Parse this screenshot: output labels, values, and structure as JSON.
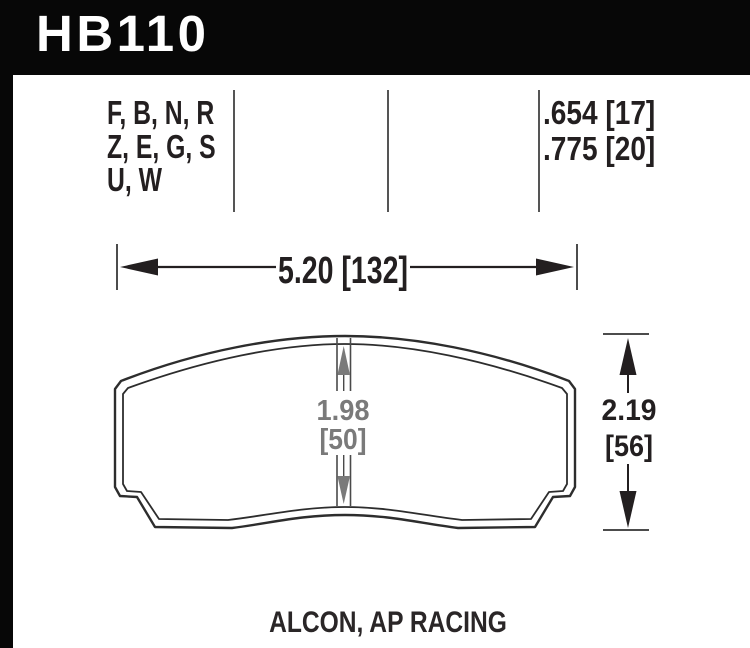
{
  "part": {
    "number": "HB110"
  },
  "spec_table": {
    "compound_lines": [
      "F, B, N, R",
      "Z, E, G, S",
      "U, W"
    ],
    "pad_thickness_lines": [
      ".654 [17]",
      ".775 [20]"
    ]
  },
  "dimensions": {
    "width_label": "5.20 [132]",
    "height_value": "2.19",
    "height_bracket": "[56]",
    "center_value": "1.98",
    "center_bracket": "[50]"
  },
  "footer": {
    "applications": "ALCON, AP RACING"
  },
  "colors": {
    "header_bg": "#070707",
    "ink": "#231f20",
    "dim_gray": "#7a7a7a",
    "line_gray": "#4c4c4c"
  }
}
